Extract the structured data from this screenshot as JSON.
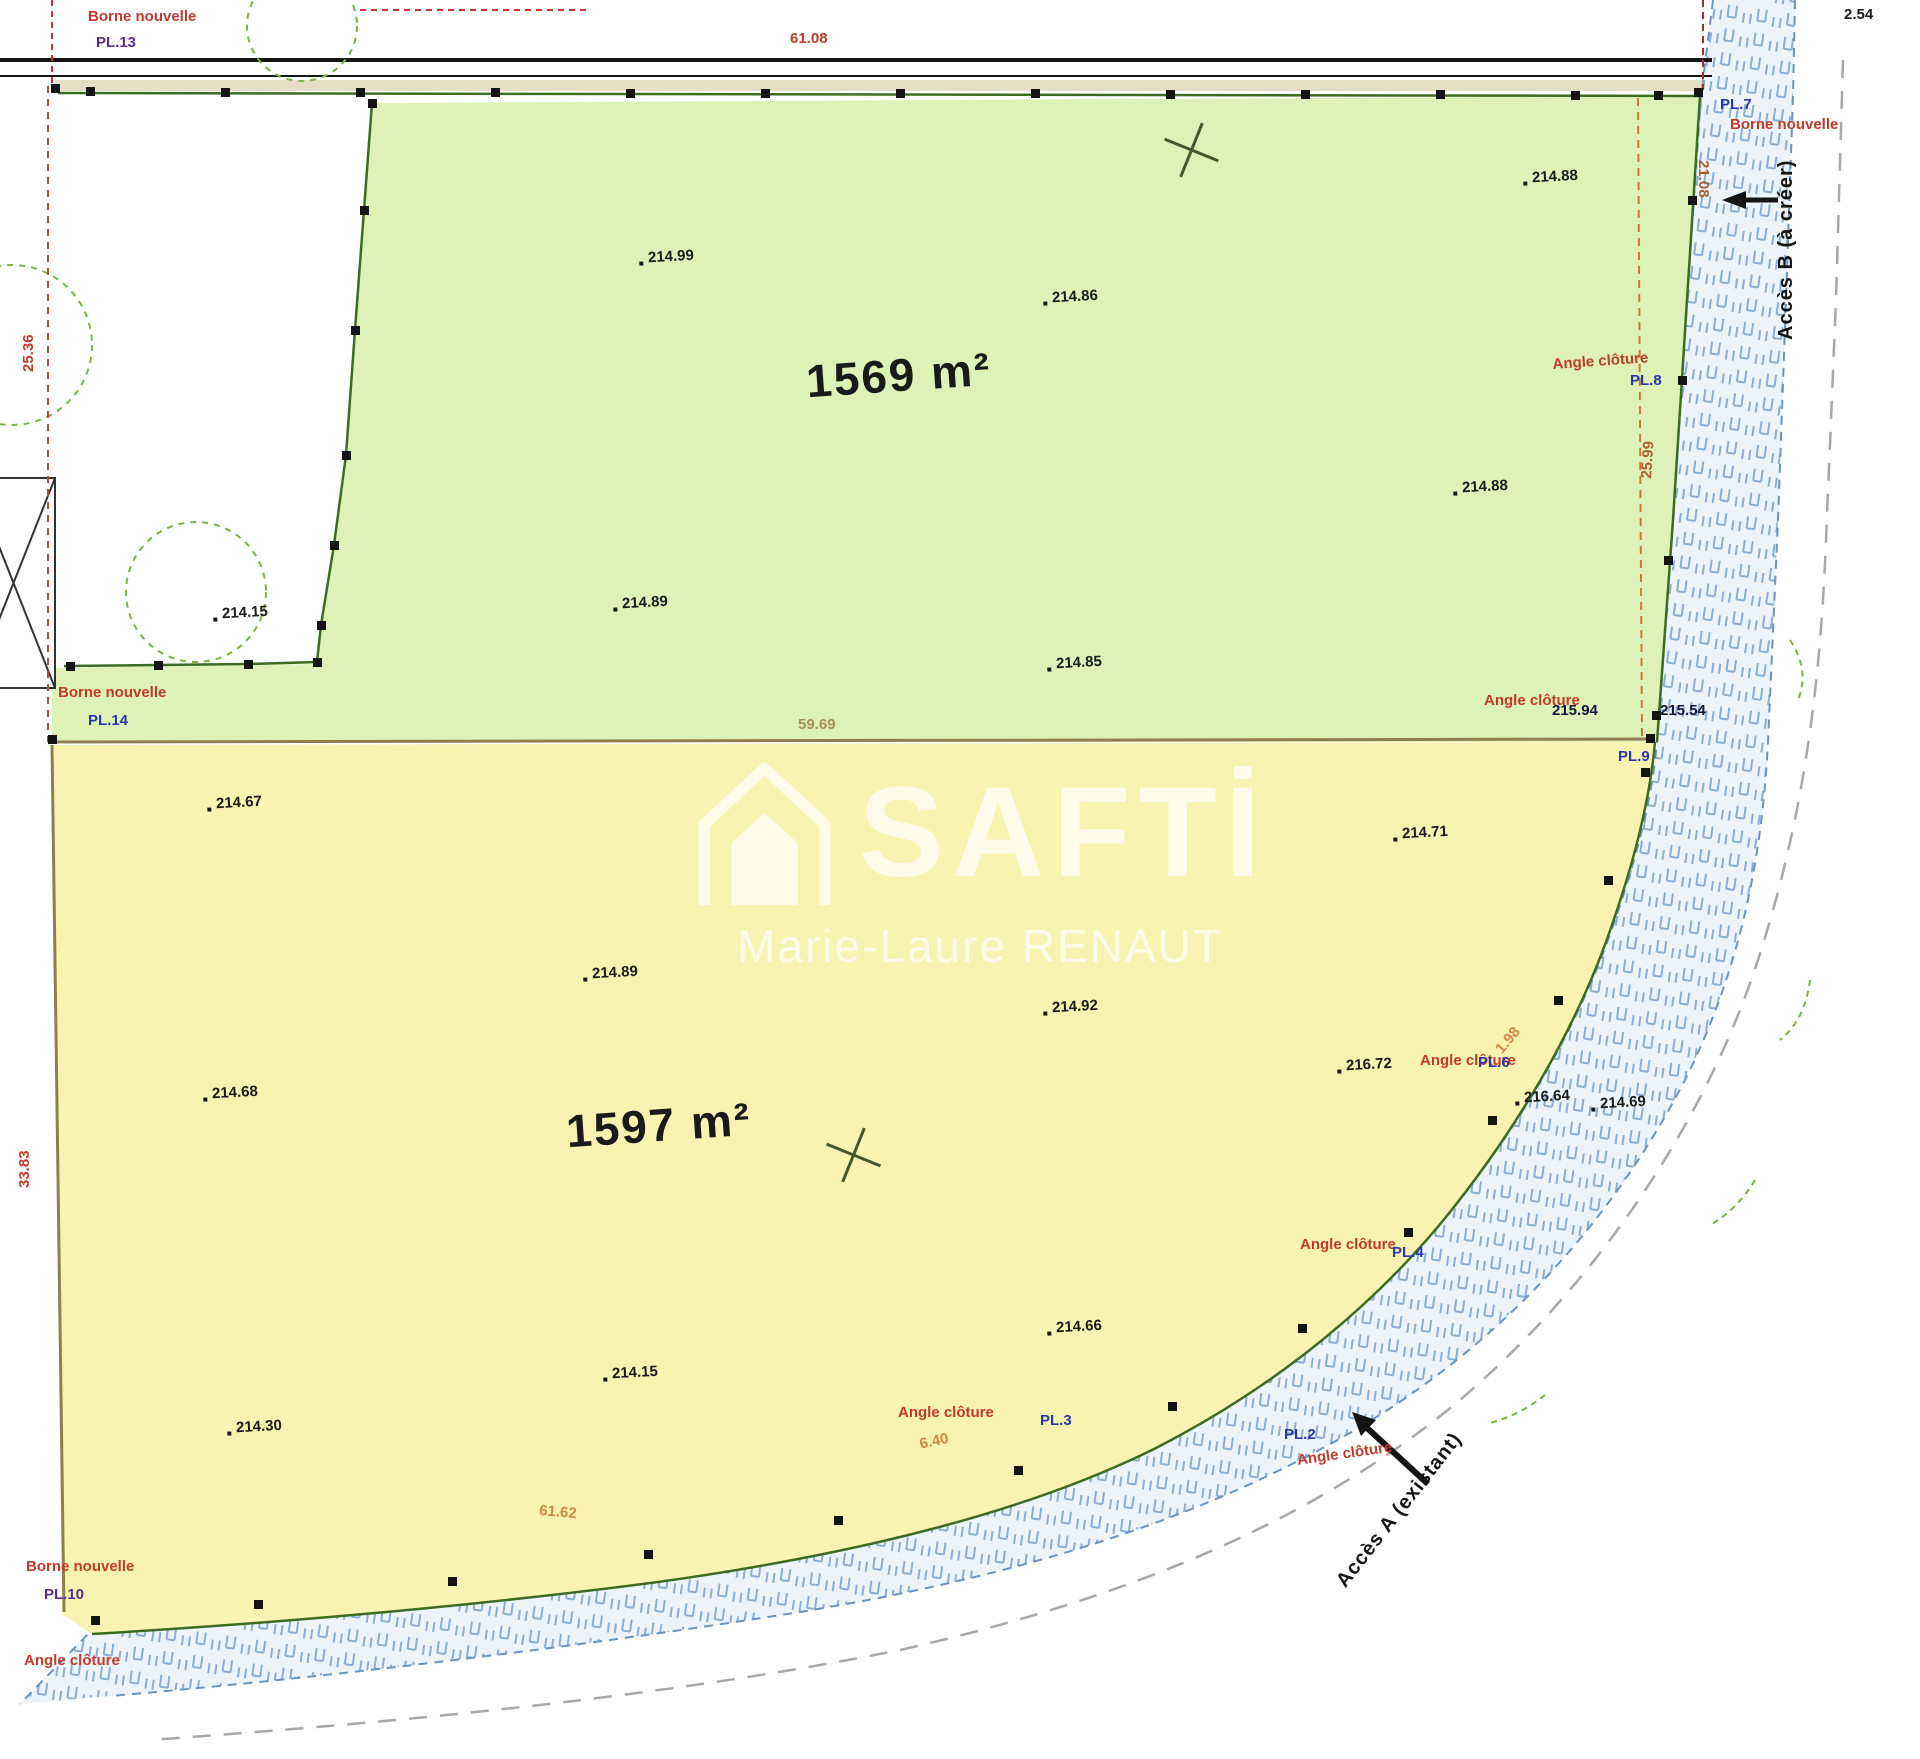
{
  "watermark": {
    "brand": "SAFTİ",
    "agent": "Marie-Laure RENAUT"
  },
  "colors": {
    "parcel_a": "#def2b8",
    "parcel_b": "#f9f3b2",
    "road_fill": "#ecf3fb",
    "road_hatch": "#8aaed4",
    "boundary_green": "#3e6b22",
    "divider_brown": "#8f7f4f",
    "red": "#c23b2a",
    "navy": "#2a37a8",
    "purple": "#5b2d8e",
    "orange": "#d07830",
    "tan": "#a8925a"
  },
  "parcels": [
    {
      "name": "parcel-green",
      "area_label": "1569 m²",
      "label_x": 806,
      "label_y": 348,
      "color": "#def2b8"
    },
    {
      "name": "parcel-yellow",
      "area_label": "1597 m²",
      "label_x": 566,
      "label_y": 1098,
      "color": "#f9f3b2"
    }
  ],
  "spot_elevations": [
    {
      "t": "214.99",
      "x": 648,
      "y": 248
    },
    {
      "t": "214.86",
      "x": 1052,
      "y": 288
    },
    {
      "t": "214.88",
      "x": 1532,
      "y": 168
    },
    {
      "t": "214.88",
      "x": 1462,
      "y": 478
    },
    {
      "t": "214.89",
      "x": 622,
      "y": 594
    },
    {
      "t": "214.85",
      "x": 1056,
      "y": 654
    },
    {
      "t": "214.15",
      "x": 222,
      "y": 604
    },
    {
      "t": "214.67",
      "x": 216,
      "y": 794
    },
    {
      "t": "214.71",
      "x": 1402,
      "y": 824
    },
    {
      "t": "214.89",
      "x": 592,
      "y": 964
    },
    {
      "t": "214.92",
      "x": 1052,
      "y": 998
    },
    {
      "t": "214.68",
      "x": 212,
      "y": 1084
    },
    {
      "t": "216.72",
      "x": 1346,
      "y": 1056
    },
    {
      "t": "216.64",
      "x": 1524,
      "y": 1088
    },
    {
      "t": "214.69",
      "x": 1600,
      "y": 1094
    },
    {
      "t": "214.66",
      "x": 1056,
      "y": 1318
    },
    {
      "t": "214.15",
      "x": 612,
      "y": 1364
    },
    {
      "t": "214.30",
      "x": 236,
      "y": 1418
    }
  ],
  "fence_labels": [
    {
      "t": "Borne nouvelle",
      "x": 88,
      "y": 8
    },
    {
      "t": "Borne nouvelle",
      "x": 1730,
      "y": 116
    },
    {
      "t": "Borne nouvelle",
      "x": 58,
      "y": 684
    },
    {
      "t": "Borne nouvelle",
      "x": 26,
      "y": 1558
    },
    {
      "t": "Angle clôture",
      "x": 1552,
      "y": 356,
      "rot": -4
    },
    {
      "t": "Angle clôture",
      "x": 1484,
      "y": 692
    },
    {
      "t": "Angle clôture",
      "x": 1420,
      "y": 1052
    },
    {
      "t": "Angle clôture",
      "x": 1300,
      "y": 1236
    },
    {
      "t": "Angle clôture",
      "x": 1296,
      "y": 1452,
      "rot": -8
    },
    {
      "t": "Angle clôture",
      "x": 898,
      "y": 1404
    },
    {
      "t": "Angle clôture",
      "x": 24,
      "y": 1652
    }
  ],
  "marker_labels": [
    {
      "t": "PL.13",
      "x": 96,
      "y": 34,
      "color": "#5b2d8e"
    },
    {
      "t": "PL.7",
      "x": 1720,
      "y": 96
    },
    {
      "t": "PL.8",
      "x": 1630,
      "y": 372
    },
    {
      "t": "PL.9",
      "x": 1618,
      "y": 748
    },
    {
      "t": "PL.14",
      "x": 88,
      "y": 712
    },
    {
      "t": "PL.6",
      "x": 1478,
      "y": 1054
    },
    {
      "t": "PL.4",
      "x": 1392,
      "y": 1244
    },
    {
      "t": "PL.3",
      "x": 1040,
      "y": 1412
    },
    {
      "t": "PL.2",
      "x": 1284,
      "y": 1426
    },
    {
      "t": "PL.10",
      "x": 44,
      "y": 1586,
      "color": "#5b2d8e"
    }
  ],
  "point_values": [
    {
      "t": "215.94",
      "x": 1552,
      "y": 702
    },
    {
      "t": "215.54",
      "x": 1660,
      "y": 702
    }
  ],
  "measurements": [
    {
      "t": "61.08",
      "x": 790,
      "y": 30,
      "color": "#c23b2a"
    },
    {
      "t": "2.54",
      "x": 1844,
      "y": 6,
      "color": "#1a1a1a"
    },
    {
      "t": "21.08",
      "x": 1712,
      "y": 160,
      "rot": 90,
      "color": "#a8612f"
    },
    {
      "t": "25.99",
      "x": 1638,
      "y": 478,
      "rot": -86,
      "color": "#a8612f"
    },
    {
      "t": "59.69",
      "x": 798,
      "y": 716,
      "color": "#a8925a"
    },
    {
      "t": "61.62",
      "x": 540,
      "y": 1502,
      "rot": 5,
      "color": "#cc8844"
    },
    {
      "t": "25.36",
      "x": 20,
      "y": 372,
      "rot": -90,
      "color": "#c23b2a"
    },
    {
      "t": "33.83",
      "x": 16,
      "y": 1188,
      "rot": -90,
      "color": "#c23b2a"
    },
    {
      "t": "1.98",
      "x": 1492,
      "y": 1046,
      "rot": -50,
      "color": "#cc8844"
    },
    {
      "t": "6.40",
      "x": 918,
      "y": 1436,
      "rot": -12,
      "color": "#cc8844"
    }
  ],
  "access_labels": [
    {
      "t": "Accès B (à créer)",
      "x": 1775,
      "y": 340,
      "rot": -90
    },
    {
      "t": "Accès A (existant)",
      "x": 1332,
      "y": 1578,
      "rot": -52
    }
  ],
  "boundary_markers": [
    [
      90,
      91
    ],
    [
      225,
      92
    ],
    [
      360,
      92
    ],
    [
      495,
      92
    ],
    [
      630,
      93
    ],
    [
      765,
      93
    ],
    [
      900,
      93
    ],
    [
      1035,
      93
    ],
    [
      1170,
      94
    ],
    [
      1305,
      94
    ],
    [
      1440,
      94
    ],
    [
      1575,
      95
    ],
    [
      1658,
      95
    ],
    [
      372,
      103
    ],
    [
      364,
      210
    ],
    [
      355,
      330
    ],
    [
      346,
      455
    ],
    [
      334,
      545
    ],
    [
      321,
      625
    ],
    [
      317,
      662
    ],
    [
      248,
      664
    ],
    [
      158,
      665
    ],
    [
      70,
      666
    ],
    [
      1692,
      200
    ],
    [
      1682,
      380
    ],
    [
      1668,
      560
    ],
    [
      1656,
      715
    ],
    [
      52,
      739
    ],
    [
      1650,
      738
    ],
    [
      1645,
      772
    ],
    [
      1608,
      880
    ],
    [
      1558,
      1000
    ],
    [
      1492,
      1120
    ],
    [
      1408,
      1232
    ],
    [
      1302,
      1328
    ],
    [
      1172,
      1406
    ],
    [
      1018,
      1470
    ],
    [
      838,
      1520
    ],
    [
      648,
      1554
    ],
    [
      452,
      1581
    ],
    [
      258,
      1604
    ],
    [
      95,
      1620
    ],
    [
      55,
      88
    ],
    [
      1698,
      92
    ]
  ],
  "crosses": [
    [
      1190,
      150
    ],
    [
      852,
      1155
    ]
  ]
}
